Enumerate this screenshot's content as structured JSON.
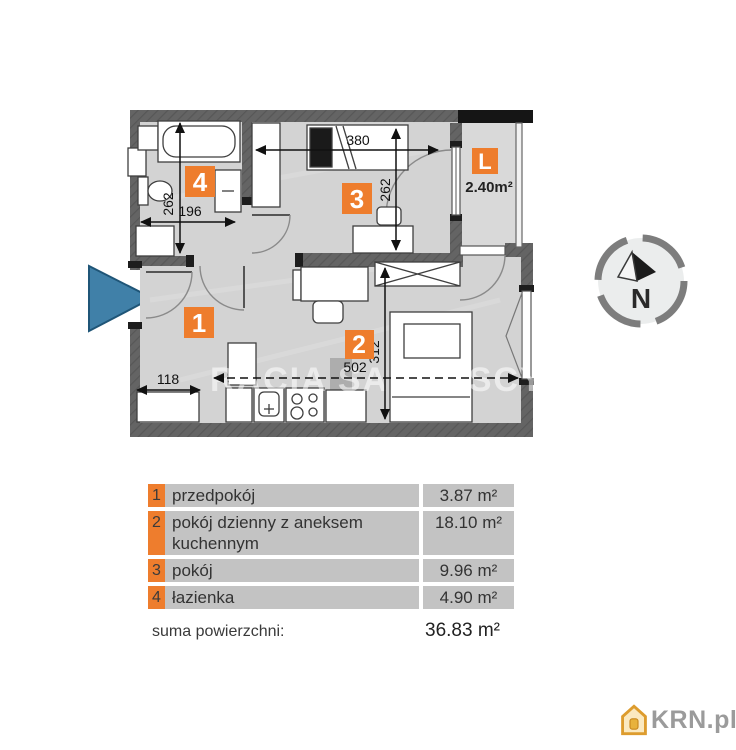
{
  "plan": {
    "badges": {
      "r1": "1",
      "r2": "2",
      "r3": "3",
      "r4": "4",
      "loggia": "L"
    },
    "loggia_area": "2.40m²",
    "dimensions": {
      "top_width": "380",
      "room3_height": "262",
      "bathroom_height": "262",
      "bathroom_width": "196",
      "hall_width": "118",
      "total_width": "502",
      "room2_height": "312"
    },
    "watermark": "RACIA SADURSCY",
    "compass_north": "N",
    "colors": {
      "accent_orange": "#ee7d2d",
      "wall_gray": "#5f5f5f",
      "floor_gray": "#d3d3d3",
      "entrance_blue": "#4080a8",
      "logo_gray": "#9b9b9b"
    }
  },
  "legend": {
    "rows": [
      {
        "num": "1",
        "name": "przedpokój",
        "area": "3.87 m²"
      },
      {
        "num": "2",
        "name": "pokój dzienny z aneksem kuchennym",
        "area": "18.10 m²"
      },
      {
        "num": "3",
        "name": "pokój",
        "area": "9.96 m²"
      },
      {
        "num": "4",
        "name": "łazienka",
        "area": "4.90 m²"
      }
    ],
    "total_label": "suma powierzchni:",
    "total_value": "36.83 m²"
  },
  "footer": {
    "logo_text": "KRN.pl"
  }
}
